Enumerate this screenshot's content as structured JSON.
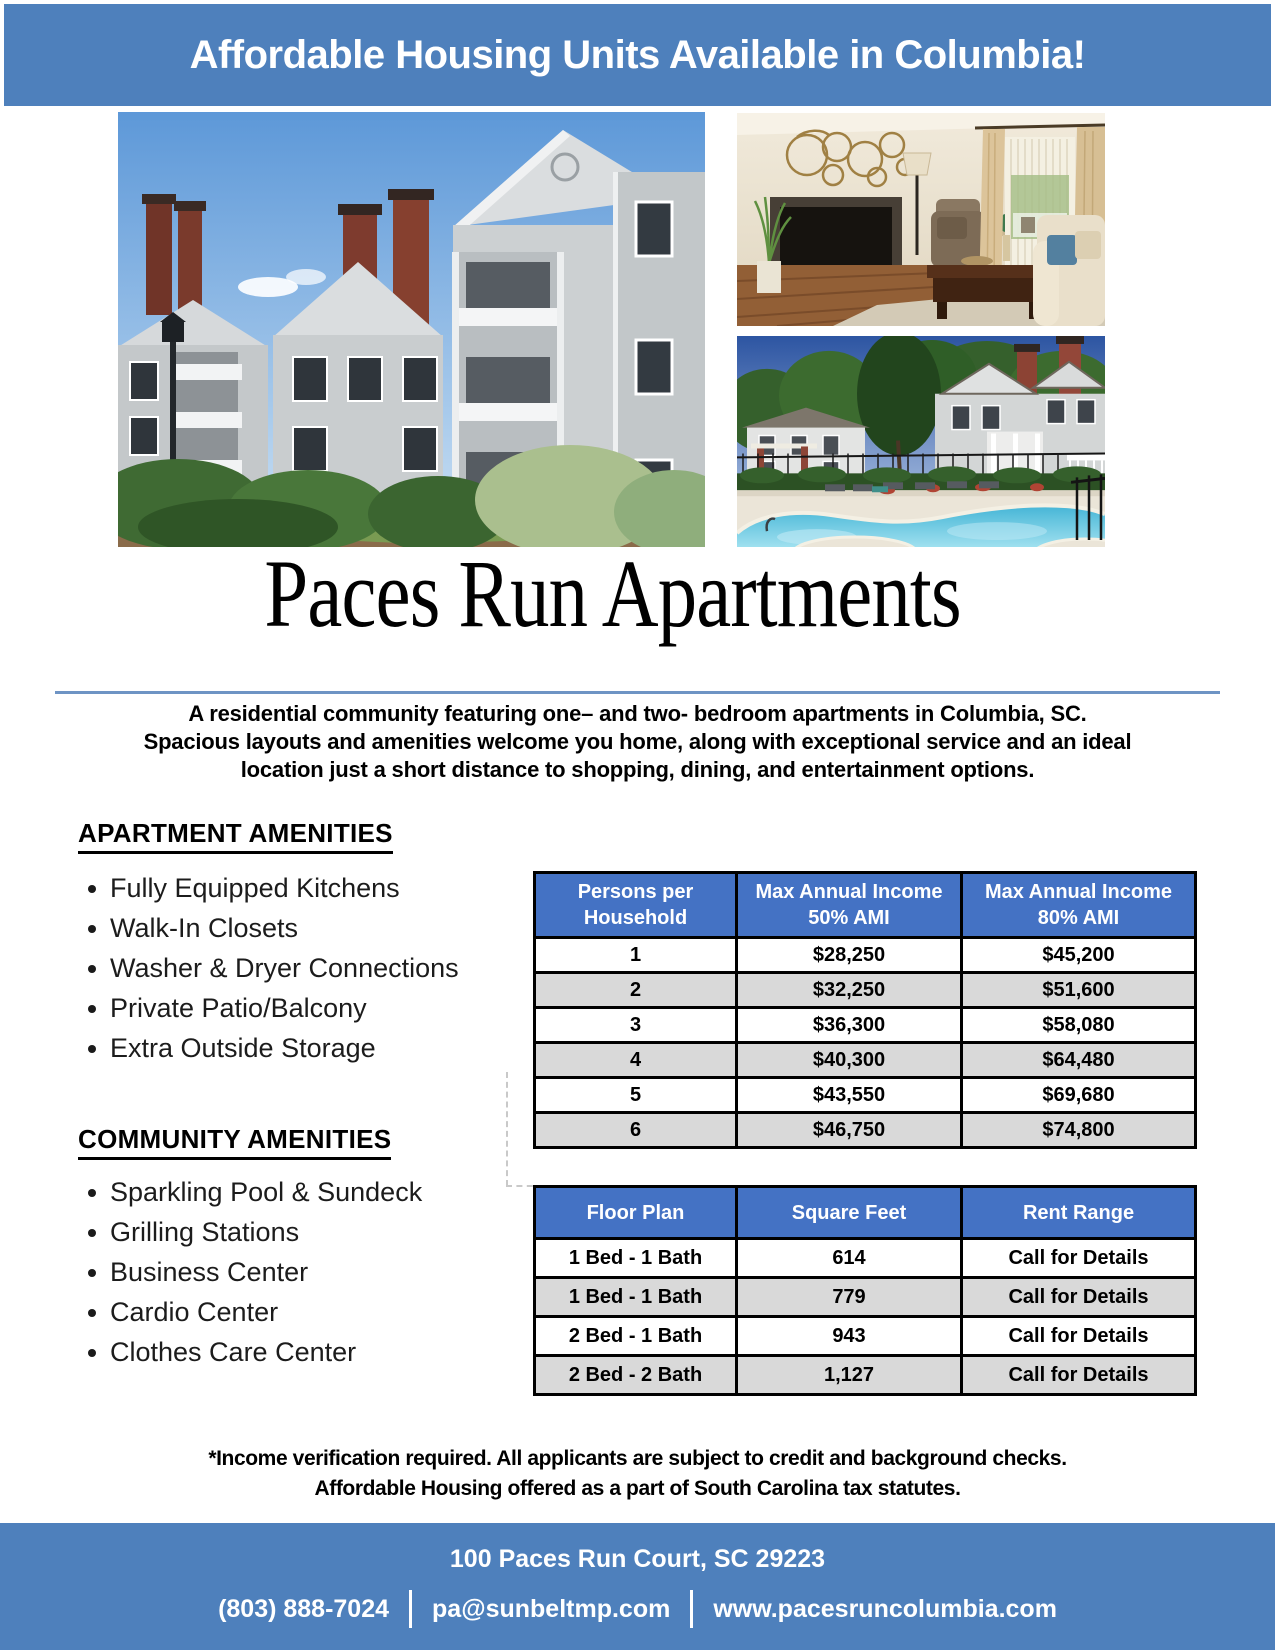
{
  "banner": {
    "title": "Affordable Housing Units Available in Columbia!"
  },
  "hero": {
    "title": "Paces Run Apartments",
    "description_lines": [
      "A residential community featuring one– and two- bedroom apartments in Columbia, SC.",
      "Spacious layouts and amenities welcome you home, along with exceptional service and an ideal",
      "location just a short distance to shopping, dining, and entertainment options."
    ]
  },
  "amenities": {
    "apartment": {
      "heading": "APARTMENT AMENITIES",
      "items": [
        "Fully Equipped Kitchens",
        "Walk-In Closets",
        "Washer & Dryer Connections",
        "Private Patio/Balcony",
        "Extra Outside Storage"
      ]
    },
    "community": {
      "heading": "COMMUNITY AMENITIES",
      "items": [
        "Sparkling Pool & Sundeck",
        "Grilling Stations",
        "Business Center",
        "Cardio Center",
        "Clothes Care Center"
      ]
    }
  },
  "income_table": {
    "headers": [
      [
        "Persons per",
        "Household"
      ],
      [
        "Max Annual Income",
        "50% AMI"
      ],
      [
        "Max Annual Income",
        "80% AMI"
      ]
    ],
    "rows": [
      [
        "1",
        "$28,250",
        "$45,200"
      ],
      [
        "2",
        "$32,250",
        "$51,600"
      ],
      [
        "3",
        "$36,300",
        "$58,080"
      ],
      [
        "4",
        "$40,300",
        "$64,480"
      ],
      [
        "5",
        "$43,550",
        "$69,680"
      ],
      [
        "6",
        "$46,750",
        "$74,800"
      ]
    ]
  },
  "floorplan_table": {
    "headers": [
      "Floor Plan",
      "Square Feet",
      "Rent Range"
    ],
    "rows": [
      [
        "1 Bed - 1 Bath",
        "614",
        "Call for Details"
      ],
      [
        "1 Bed - 1 Bath",
        "779",
        "Call for Details"
      ],
      [
        "2 Bed - 1 Bath",
        "943",
        "Call for Details"
      ],
      [
        "2 Bed - 2 Bath",
        "1,127",
        "Call for Details"
      ]
    ]
  },
  "disclaimer_lines": [
    "*Income verification required. All applicants are subject to credit and background checks.",
    "Affordable Housing offered as a part of South Carolina tax statutes."
  ],
  "footer": {
    "address": "100 Paces Run Court, SC 29223",
    "phone": "(803) 888-7024",
    "email": "pa@sunbeltmp.com",
    "website": "www.pacesruncolumbia.com"
  },
  "photos": {
    "exterior": "apartment-building-exterior",
    "living_room": "furnished-living-room-interior",
    "pool": "community-swimming-pool"
  },
  "colors": {
    "banner_blue": "#4e80bc",
    "table_header_blue": "#4472c4",
    "row_alt_gray": "#d9d9d9",
    "divider_blue": "#6e94c4"
  }
}
